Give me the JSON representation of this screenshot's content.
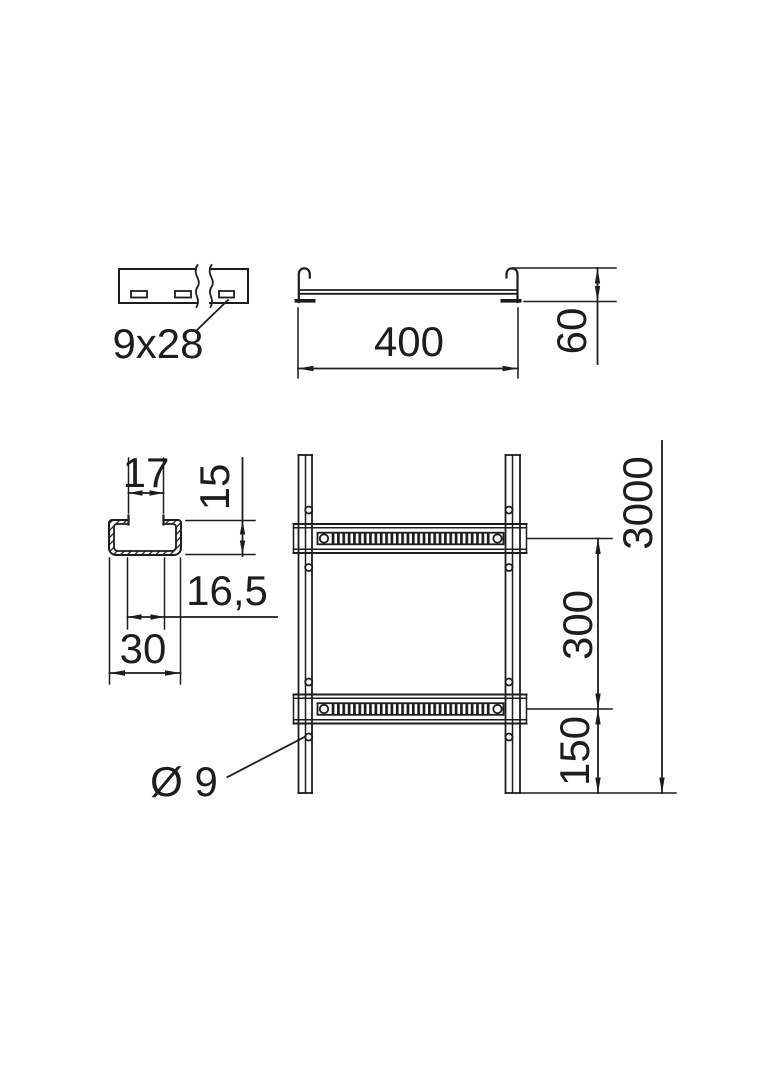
{
  "colors": {
    "line": "#1d1d1b",
    "background": "#ffffff"
  },
  "strip_view": {
    "slot_label": "9x28"
  },
  "cross_section": {
    "width_label": "400",
    "height_label": "60"
  },
  "rung_profile": {
    "opening_width_label": "17",
    "height_label": "15",
    "inner_width_label": "16,5",
    "width_label": "30"
  },
  "ladder_view": {
    "length_label": "3000",
    "rung_spacing_label": "300",
    "end_spacing_label": "150",
    "hole_diameter_label": "Ø 9"
  }
}
